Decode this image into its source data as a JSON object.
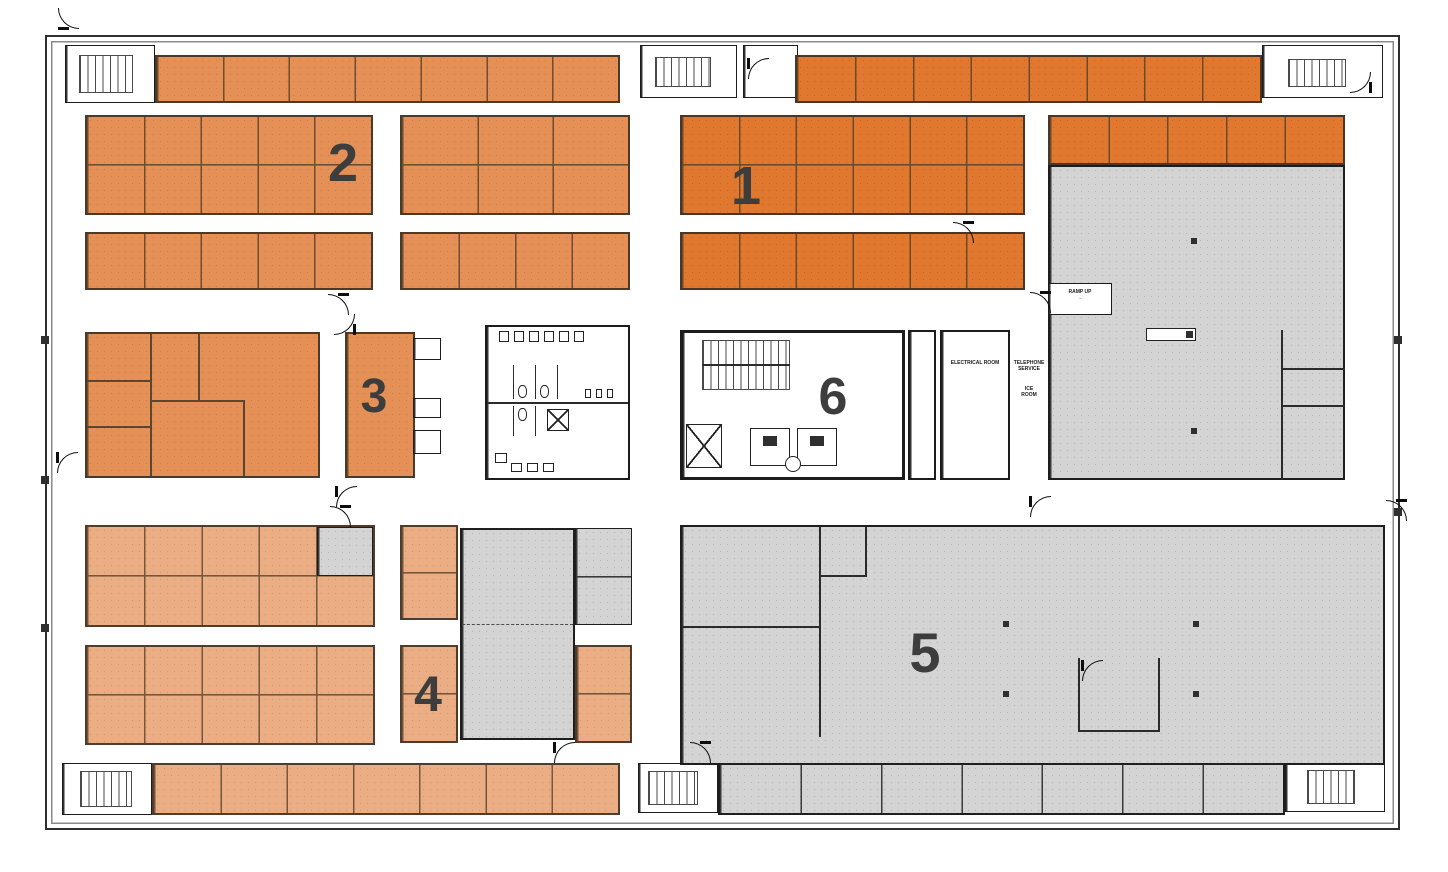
{
  "diagram": {
    "type": "architectural-floor-plan",
    "zones": [
      {
        "id": 1,
        "label": "1"
      },
      {
        "id": 2,
        "label": "2"
      },
      {
        "id": 3,
        "label": "3"
      },
      {
        "id": 4,
        "label": "4"
      },
      {
        "id": 5,
        "label": "5"
      },
      {
        "id": 6,
        "label": "6"
      }
    ],
    "room_labels": {
      "ramp_up": "RAMP UP\n→",
      "electrical_room": "ELECTRICAL ROOM",
      "telephone_service": "TELEPHONE\nSERVICE",
      "ice_room": "ICE\nROOM"
    },
    "colors": {
      "zone_dark_orange": "#E0792F",
      "zone_medium_orange": "#E49057",
      "zone_light_orange": "#EBAD83",
      "shell_gray": "#D4D4D4",
      "wall_dark": "#1E1E1E",
      "label_gray": "#3D3D3D",
      "background": "#FFFFFF"
    }
  }
}
